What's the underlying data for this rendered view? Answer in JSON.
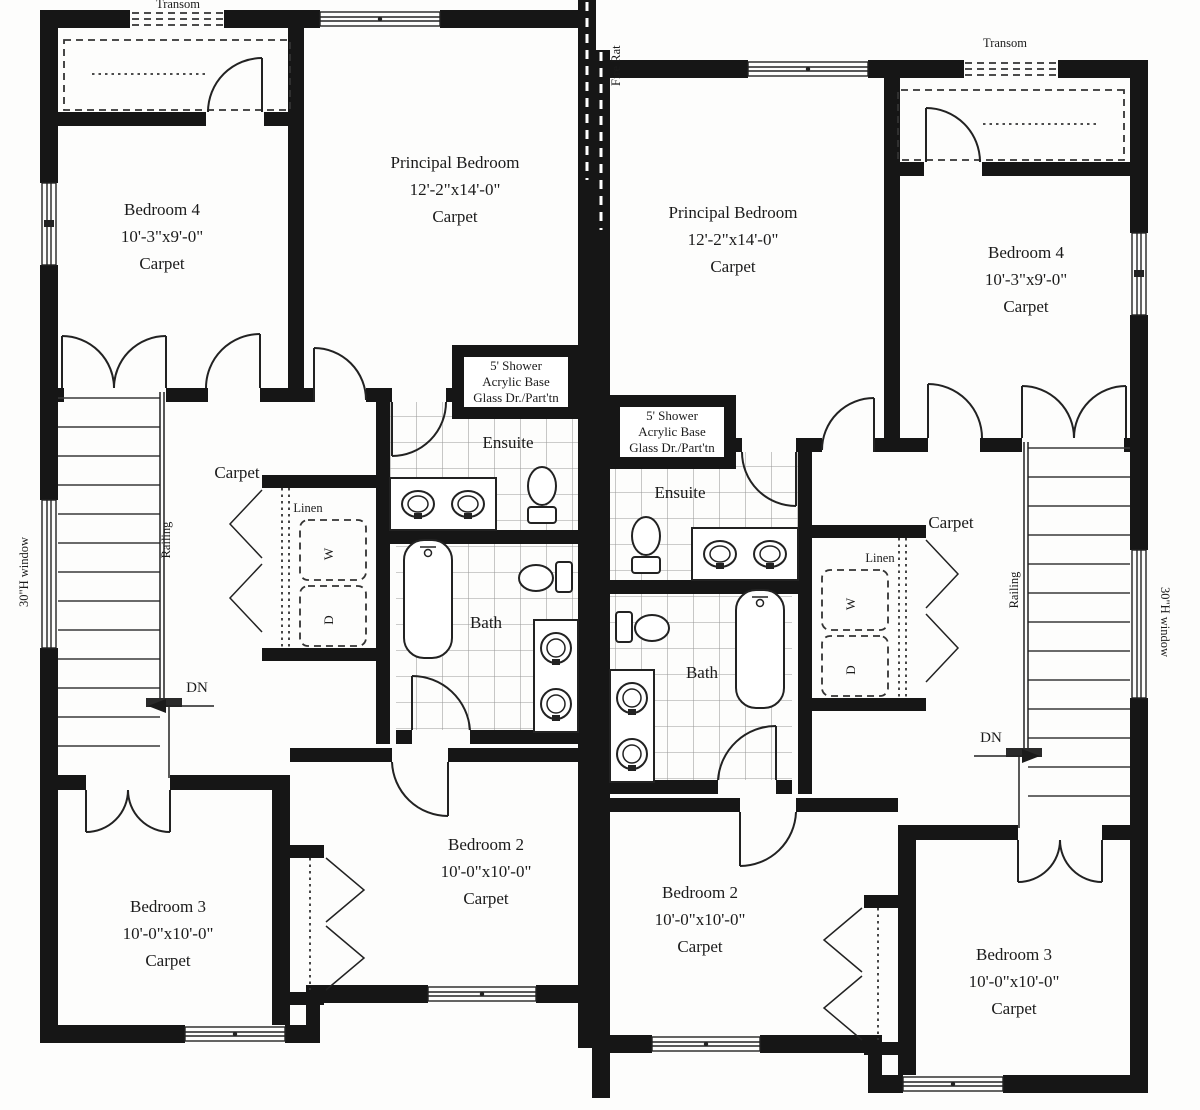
{
  "colors": {
    "wall": "#161616",
    "line": "#222222",
    "tile_line": "#999999",
    "background": "#fdfdfc"
  },
  "shared": {
    "fire_wall_label": "Fire Rat"
  },
  "left": {
    "transom_label": "Transom",
    "principal_bedroom": {
      "name": "Principal Bedroom",
      "dims": "12'-2\"x14'-0\"",
      "floor": "Carpet"
    },
    "bedroom4": {
      "name": "Bedroom 4",
      "dims": "10'-3\"x9'-0\"",
      "floor": "Carpet"
    },
    "bedroom2": {
      "name": "Bedroom 2",
      "dims": "10'-0\"x10'-0\"",
      "floor": "Carpet"
    },
    "bedroom3": {
      "name": "Bedroom 3",
      "dims": "10'-0\"x10'-0\"",
      "floor": "Carpet"
    },
    "shower": {
      "line1": "5' Shower",
      "line2": "Acrylic Base",
      "line3": "Glass Dr./Part'tn"
    },
    "ensuite_label": "Ensuite",
    "bath_label": "Bath",
    "hall_floor": "Carpet",
    "railing_label": "Railing",
    "window_label": "30\"H window",
    "linen_label": "Linen",
    "washer_label": "W",
    "dryer_label": "D",
    "down_label": "DN"
  },
  "right": {
    "transom_label": "Transom",
    "principal_bedroom": {
      "name": "Principal Bedroom",
      "dims": "12'-2\"x14'-0\"",
      "floor": "Carpet"
    },
    "bedroom4": {
      "name": "Bedroom 4",
      "dims": "10'-3\"x9'-0\"",
      "floor": "Carpet"
    },
    "bedroom2": {
      "name": "Bedroom 2",
      "dims": "10'-0\"x10'-0\"",
      "floor": "Carpet"
    },
    "bedroom3": {
      "name": "Bedroom 3",
      "dims": "10'-0\"x10'-0\"",
      "floor": "Carpet"
    },
    "shower": {
      "line1": "5' Shower",
      "line2": "Acrylic Base",
      "line3": "Glass Dr./Part'tn"
    },
    "ensuite_label": "Ensuite",
    "bath_label": "Bath",
    "hall_floor": "Carpet",
    "railing_label": "Railing",
    "window_label": "30\"H window",
    "linen_label": "Linen",
    "washer_label": "W",
    "dryer_label": "D",
    "down_label": "DN"
  }
}
